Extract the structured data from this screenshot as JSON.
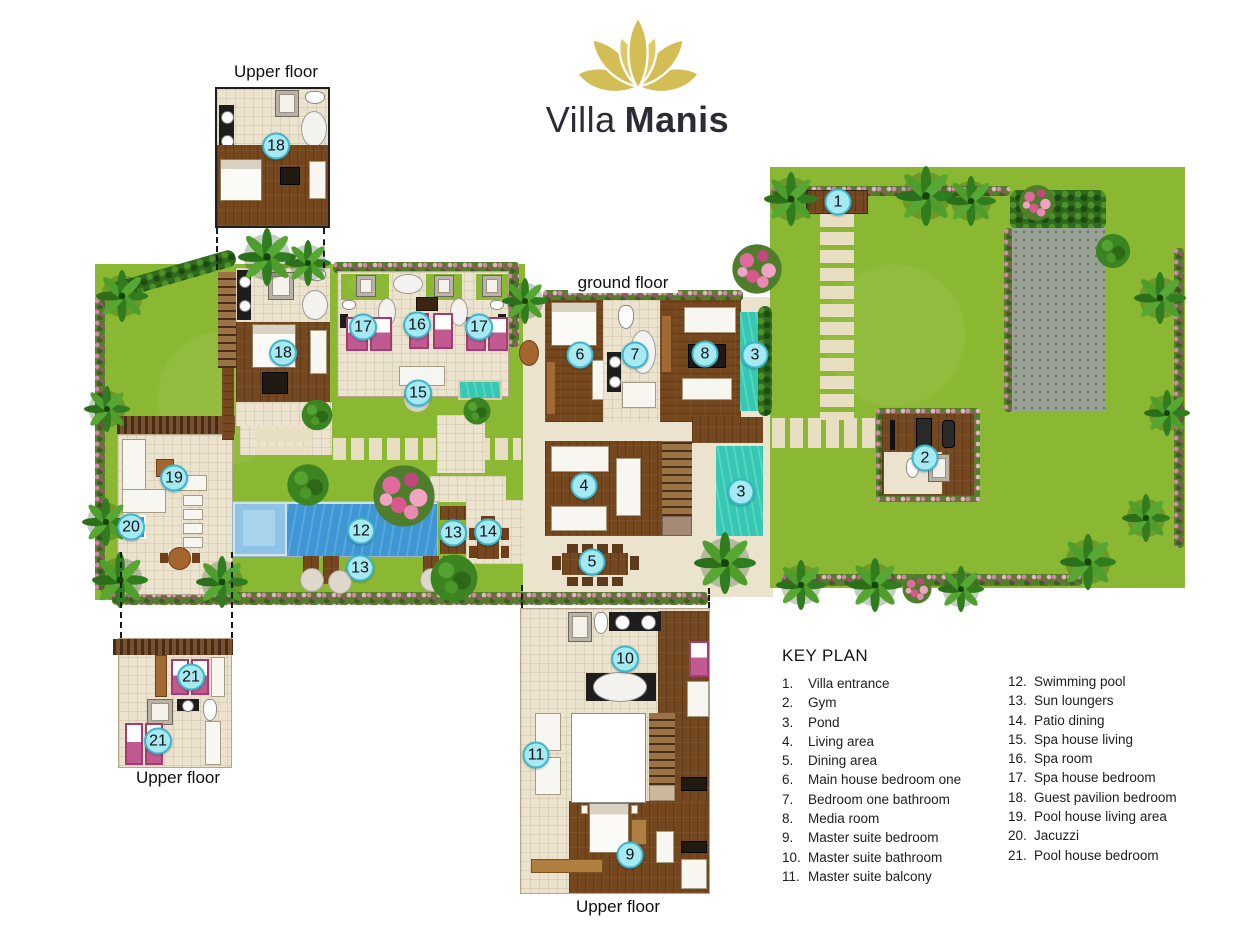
{
  "logo": {
    "title_light": "Villa",
    "title_bold": "Manis"
  },
  "labels": {
    "guest_upper": "Upper floor",
    "ground": "ground floor",
    "pool_upper": "Upper floor",
    "master_upper": "Upper floor"
  },
  "key_plan": {
    "heading": "KEY PLAN",
    "items_col1": [
      {
        "num": "1.",
        "label": "Villa entrance"
      },
      {
        "num": "2.",
        "label": "Gym"
      },
      {
        "num": "3.",
        "label": "Pond"
      },
      {
        "num": "4.",
        "label": "Living area"
      },
      {
        "num": "5.",
        "label": "Dining area"
      },
      {
        "num": "6.",
        "label": "Main house bedroom one"
      },
      {
        "num": "7.",
        "label": "Bedroom one bathroom"
      },
      {
        "num": "8.",
        "label": "Media room"
      },
      {
        "num": "9.",
        "label": "Master suite bedroom"
      },
      {
        "num": "10.",
        "label": "Master suite bathroom"
      },
      {
        "num": "11.",
        "label": "Master suite balcony"
      }
    ],
    "items_col2": [
      {
        "num": "12.",
        "label": "Swimming pool"
      },
      {
        "num": "13.",
        "label": "Sun loungers"
      },
      {
        "num": "14.",
        "label": "Patio dining"
      },
      {
        "num": "15.",
        "label": "Spa house living"
      },
      {
        "num": "16.",
        "label": "Spa room"
      },
      {
        "num": "17.",
        "label": "Spa house bedroom"
      },
      {
        "num": "18.",
        "label": "Guest pavilion bedroom"
      },
      {
        "num": "19.",
        "label": "Pool house living area"
      },
      {
        "num": "20.",
        "label": "Jacuzzi"
      },
      {
        "num": "21.",
        "label": "Pool house bedroom"
      }
    ]
  },
  "markers": [
    {
      "name": "villa-entrance",
      "num": "1",
      "x": 838,
      "y": 202
    },
    {
      "name": "gym",
      "num": "2",
      "x": 925,
      "y": 458
    },
    {
      "name": "pond-upper",
      "num": "3",
      "x": 755,
      "y": 355
    },
    {
      "name": "pond-lower",
      "num": "3",
      "x": 741,
      "y": 492
    },
    {
      "name": "living-area",
      "num": "4",
      "x": 584,
      "y": 486
    },
    {
      "name": "dining-area",
      "num": "5",
      "x": 592,
      "y": 562
    },
    {
      "name": "main-house-bedroom-one",
      "num": "6",
      "x": 580,
      "y": 355
    },
    {
      "name": "bedroom-one-bathroom",
      "num": "7",
      "x": 635,
      "y": 355
    },
    {
      "name": "media-room",
      "num": "8",
      "x": 705,
      "y": 354
    },
    {
      "name": "master-suite-bedroom",
      "num": "9",
      "x": 630,
      "y": 855
    },
    {
      "name": "master-suite-bathroom",
      "num": "10",
      "x": 625,
      "y": 659
    },
    {
      "name": "master-suite-balcony",
      "num": "11",
      "x": 536,
      "y": 755
    },
    {
      "name": "swimming-pool",
      "num": "12",
      "x": 361,
      "y": 531
    },
    {
      "name": "sun-loungers-east",
      "num": "13",
      "x": 453,
      "y": 533
    },
    {
      "name": "sun-loungers-south",
      "num": "13",
      "x": 360,
      "y": 568
    },
    {
      "name": "patio-dining",
      "num": "14",
      "x": 488,
      "y": 532
    },
    {
      "name": "spa-house-living",
      "num": "15",
      "x": 418,
      "y": 393
    },
    {
      "name": "spa-room",
      "num": "16",
      "x": 417,
      "y": 325
    },
    {
      "name": "spa-house-bedroom-west",
      "num": "17",
      "x": 363,
      "y": 327
    },
    {
      "name": "spa-house-bedroom-east",
      "num": "17",
      "x": 479,
      "y": 327
    },
    {
      "name": "guest-pavilion-bedroom-upper",
      "num": "18",
      "x": 276,
      "y": 146
    },
    {
      "name": "guest-pavilion-bedroom",
      "num": "18",
      "x": 283,
      "y": 353
    },
    {
      "name": "pool-house-living-area",
      "num": "19",
      "x": 174,
      "y": 478
    },
    {
      "name": "jacuzzi",
      "num": "20",
      "x": 131,
      "y": 527
    },
    {
      "name": "pool-house-bedroom-a",
      "num": "21",
      "x": 191,
      "y": 677
    },
    {
      "name": "pool-house-bedroom-b",
      "num": "21",
      "x": 158,
      "y": 741
    }
  ],
  "colors": {
    "marker_fill": "#a5e9f2",
    "marker_border": "#3fb5c9",
    "grass": "#8ab832",
    "pool_blue": "#3e97d4",
    "pond_teal": "#35c9b4",
    "wood_brown": "#74471f",
    "tile_cream": "#ece3cf",
    "logo_gold": "#d3bd55"
  }
}
